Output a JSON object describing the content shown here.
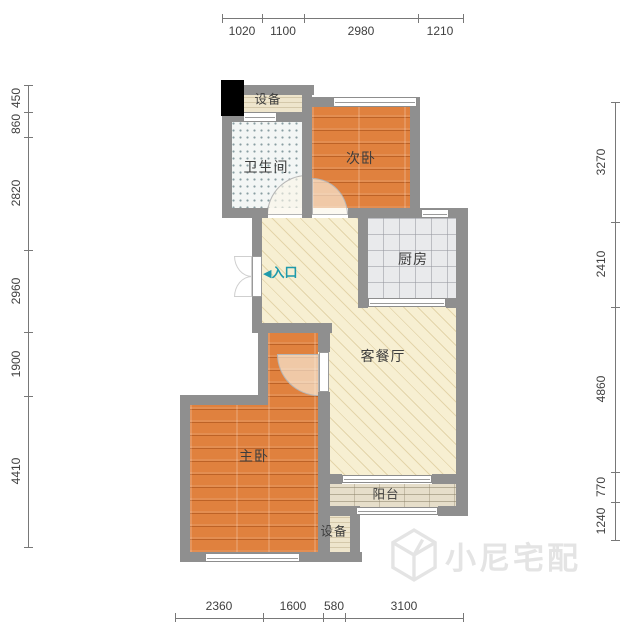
{
  "dimensions": {
    "top": [
      "1020",
      "1100",
      "2980",
      "1210"
    ],
    "bottom": [
      "2360",
      "1600",
      "580",
      "3100"
    ],
    "left": [
      "450",
      "860",
      "2820",
      "2960",
      "1900",
      "4410"
    ],
    "right": [
      "3270",
      "2410",
      "4860",
      "770",
      "1240"
    ]
  },
  "rooms": {
    "equipment_top": "设备",
    "bathroom": "卫生间",
    "secondary_bedroom": "次卧",
    "kitchen": "厨房",
    "living_dining": "客餐厅",
    "master_bedroom": "主卧",
    "balcony": "阳台",
    "equipment_bottom": "设备"
  },
  "entrance": {
    "arrow": "◀",
    "label": "入口",
    "color": "#1f9aab"
  },
  "watermark": {
    "text": "小尼宅配",
    "color": "#e4e4e4"
  },
  "colors": {
    "wall": "#8f8f8f",
    "wood_floor": "#e0813e",
    "living_floor": "#f7efd2",
    "kitchen_tile": "#e9eaec",
    "bathroom_tile": "#f3f6f5",
    "balcony_floor": "#e6deca",
    "equipment_floor": "#eee5cc",
    "dimension_text": "#3f3f3f",
    "column": "#000000"
  }
}
